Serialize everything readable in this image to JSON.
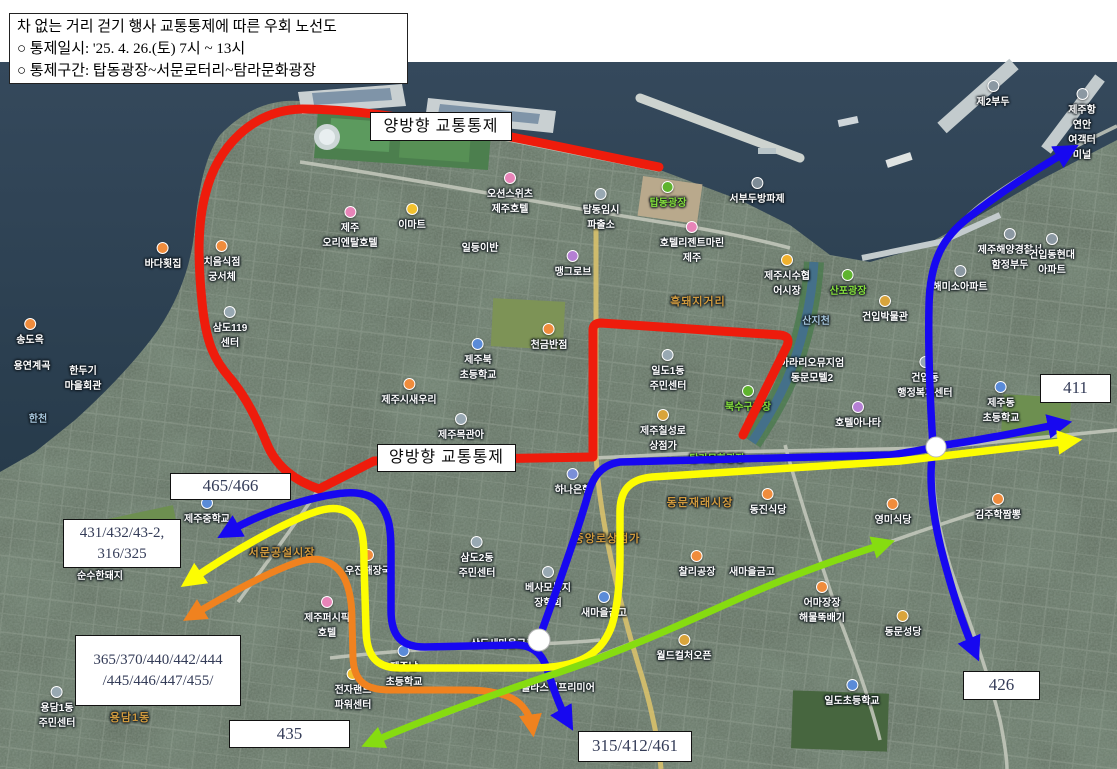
{
  "info_box": {
    "line1": "차 없는 거리 걷기 행사 교통통제에 따른 우회 노선도",
    "line2": "○ 통제일시: '25. 4. 26.(토) 7시 ~ 13시",
    "line3": "○ 통제구간: 탑동광장~서문로터리~탐라문화광장"
  },
  "control_labels": {
    "top": "양방향 교통통제",
    "middle": "양방향 교통통제"
  },
  "route_badges": {
    "east_411": "411",
    "west_465": "465/466",
    "west_431_line1": "431/432/43-2,",
    "west_431_line2": "316/325",
    "west_365_line1": "365/370/440/442/444",
    "west_365_line2": "/445/446/447/455/",
    "south_435": "435",
    "south_315": "315/412/461",
    "southeast_426": "426"
  },
  "badge_route_association": {
    "411": "blue",
    "465/466": "blue",
    "431/432/43-2, 316/325": "yellow",
    "365/370/440/442/444/445/446/447/455/": "orange",
    "435": "green",
    "315/412/461": "blue",
    "426": "blue"
  },
  "route_colors": {
    "red": "#ee1c0c",
    "blue": "#1708f0",
    "yellow": "#fdfd02",
    "orange": "#f0821f",
    "green": "#86dc10",
    "node": "#ffffff"
  },
  "map_labels": [
    {
      "text": "이마트",
      "x": 412,
      "y": 203,
      "type": "poi",
      "icon": "#f2c12e"
    },
    {
      "text": "오션스위츠\n제주호텔",
      "x": 510,
      "y": 172,
      "type": "poi",
      "icon": "#e884b8"
    },
    {
      "text": "탑동임시\n파출소",
      "x": 601,
      "y": 188,
      "type": "poi",
      "icon": "#98a8b2"
    },
    {
      "text": "탑동광장",
      "x": 668,
      "y": 181,
      "type": "green",
      "icon": "#5fb32e"
    },
    {
      "text": "서부두방파제",
      "x": 757,
      "y": 177,
      "type": "poi",
      "icon": "#7d8b96"
    },
    {
      "text": "호텔리젠트마린\n제주",
      "x": 692,
      "y": 221,
      "type": "poi",
      "icon": "#e884b8"
    },
    {
      "text": "제주\n오리엔탈호텔",
      "x": 350,
      "y": 206,
      "type": "poi",
      "icon": "#e884b8"
    },
    {
      "text": "제주시수협\n어시장",
      "x": 787,
      "y": 254,
      "type": "poi",
      "icon": "#f0b12e"
    },
    {
      "text": "산포광장",
      "x": 848,
      "y": 269,
      "type": "green",
      "icon": "#5fb32e"
    },
    {
      "text": "건입박물관",
      "x": 885,
      "y": 295,
      "type": "poi",
      "icon": "#d9a43b"
    },
    {
      "text": "맹그로브",
      "x": 573,
      "y": 250,
      "type": "poi",
      "icon": "#b57fd4"
    },
    {
      "text": "일등이반",
      "x": 480,
      "y": 239,
      "type": "poi"
    },
    {
      "text": "제2부두",
      "x": 993,
      "y": 80,
      "type": "poi",
      "icon": "#8b98a2"
    },
    {
      "text": "제주항연안\n여객터미널",
      "x": 1082,
      "y": 88,
      "type": "poi",
      "icon": "#8b98a2"
    },
    {
      "text": "제주해양경찰서\n함정부두",
      "x": 1010,
      "y": 228,
      "type": "poi",
      "icon": "#8b98a2"
    },
    {
      "text": "건입동현대\n아파트",
      "x": 1052,
      "y": 233,
      "type": "poi",
      "icon": "#8b98a2"
    },
    {
      "text": "해미소아파트",
      "x": 960,
      "y": 265,
      "type": "poi",
      "icon": "#8b98a2"
    },
    {
      "text": "건입동\n행정복지센터",
      "x": 925,
      "y": 356,
      "type": "poi",
      "icon": "#98a8b2"
    },
    {
      "text": "제주동\n초등학교",
      "x": 1001,
      "y": 381,
      "type": "poi",
      "icon": "#5a8bd8"
    },
    {
      "text": "제주중학교",
      "x": 207,
      "y": 497,
      "type": "poi",
      "icon": "#5a8bd8"
    },
    {
      "text": "제주북\n초등학교",
      "x": 478,
      "y": 338,
      "type": "poi",
      "icon": "#5a8bd8"
    },
    {
      "text": "제주시새우리",
      "x": 409,
      "y": 378,
      "type": "poi",
      "icon": "#f08c3c"
    },
    {
      "text": "제주목관아",
      "x": 461,
      "y": 413,
      "type": "poi",
      "icon": "#98a8b2"
    },
    {
      "text": "천금반점",
      "x": 549,
      "y": 323,
      "type": "poi",
      "icon": "#f08c3c"
    },
    {
      "text": "하나은행",
      "x": 573,
      "y": 468,
      "type": "poi",
      "icon": "#7a8fd8"
    },
    {
      "text": "삼도2동\n주민센터",
      "x": 477,
      "y": 536,
      "type": "poi",
      "icon": "#98a8b2"
    },
    {
      "text": "베사모복지\n장학회",
      "x": 548,
      "y": 566,
      "type": "poi",
      "icon": "#98a8b2"
    },
    {
      "text": "새마을금고",
      "x": 604,
      "y": 591,
      "type": "poi",
      "icon": "#5a8bd8"
    },
    {
      "text": "새마을금고",
      "x": 752,
      "y": 563,
      "type": "poi"
    },
    {
      "text": "동진식당",
      "x": 768,
      "y": 488,
      "type": "poi",
      "icon": "#f08c3c"
    },
    {
      "text": "영미식당",
      "x": 893,
      "y": 498,
      "type": "poi",
      "icon": "#f08c3c"
    },
    {
      "text": "김주학짬뽕",
      "x": 998,
      "y": 493,
      "type": "poi",
      "icon": "#f08c3c"
    },
    {
      "text": "어마장장\n해물뚝배기",
      "x": 822,
      "y": 581,
      "type": "poi",
      "icon": "#f08c3c"
    },
    {
      "text": "동문성당",
      "x": 903,
      "y": 610,
      "type": "poi",
      "icon": "#d9a43b"
    },
    {
      "text": "일도초등학교",
      "x": 852,
      "y": 679,
      "type": "poi",
      "icon": "#5a8bd8"
    },
    {
      "text": "월드컬처오픈",
      "x": 684,
      "y": 634,
      "type": "poi",
      "icon": "#d9a43b"
    },
    {
      "text": "플라스틱프리미어",
      "x": 558,
      "y": 679,
      "type": "poi"
    },
    {
      "text": "제주퍼시픽\n호텔",
      "x": 327,
      "y": 596,
      "type": "poi",
      "icon": "#e884b8"
    },
    {
      "text": "전자랜드\n파워센터",
      "x": 353,
      "y": 668,
      "type": "poi",
      "icon": "#f2c12e"
    },
    {
      "text": "용담1동\n주민센터",
      "x": 57,
      "y": 686,
      "type": "poi",
      "icon": "#98a8b2"
    },
    {
      "text": "일도1동\n주민센터",
      "x": 668,
      "y": 349,
      "type": "poi",
      "icon": "#98a8b2"
    },
    {
      "text": "아라리오뮤지엄\n동문모텔2",
      "x": 812,
      "y": 354,
      "type": "poi"
    },
    {
      "text": "호텔아나타",
      "x": 858,
      "y": 401,
      "type": "poi",
      "icon": "#b57fd4"
    },
    {
      "text": "치음식점\n궁서체",
      "x": 222,
      "y": 240,
      "type": "poi",
      "icon": "#f08c3c"
    },
    {
      "text": "바다횟집",
      "x": 163,
      "y": 242,
      "type": "poi",
      "icon": "#f08c3c"
    },
    {
      "text": "한두기\n마을회관",
      "x": 83,
      "y": 362,
      "type": "poi"
    },
    {
      "text": "송도옥",
      "x": 30,
      "y": 318,
      "type": "poi",
      "icon": "#f08c3c"
    },
    {
      "text": "용연계곡",
      "x": 32,
      "y": 357,
      "type": "poi"
    },
    {
      "text": "한천",
      "x": 38,
      "y": 410,
      "type": "water"
    },
    {
      "text": "순수한돼지",
      "x": 100,
      "y": 567,
      "type": "poi"
    },
    {
      "text": "삼도119\n센터",
      "x": 230,
      "y": 306,
      "type": "poi",
      "icon": "#98a8b2"
    },
    {
      "text": "제주남\n초등학교",
      "x": 404,
      "y": 645,
      "type": "poi",
      "icon": "#5a8bd8"
    },
    {
      "text": "삼도새마을금고",
      "x": 503,
      "y": 635,
      "type": "poi"
    },
    {
      "text": "찰리공장",
      "x": 697,
      "y": 550,
      "type": "poi",
      "icon": "#f08c3c"
    },
    {
      "text": "우진해장국",
      "x": 368,
      "y": 549,
      "type": "poi",
      "icon": "#f08c3c"
    },
    {
      "text": "탐라문화광장",
      "x": 717,
      "y": 450,
      "type": "green"
    },
    {
      "text": "북수구광장",
      "x": 748,
      "y": 385,
      "type": "green",
      "icon": "#5fb32e"
    },
    {
      "text": "제주칠성로\n상점가",
      "x": 663,
      "y": 409,
      "type": "poi",
      "icon": "#d9a43b"
    },
    {
      "text": "서문공설시장",
      "x": 282,
      "y": 544,
      "type": "district"
    },
    {
      "text": "용담1동",
      "x": 130,
      "y": 709,
      "type": "district"
    },
    {
      "text": "흑돼지거리",
      "x": 698,
      "y": 293,
      "type": "district"
    },
    {
      "text": "동문재래시장",
      "x": 700,
      "y": 494,
      "type": "district"
    },
    {
      "text": "중앙로상점가",
      "x": 607,
      "y": 530,
      "type": "district"
    },
    {
      "text": "산지천",
      "x": 816,
      "y": 312,
      "type": "water"
    }
  ]
}
